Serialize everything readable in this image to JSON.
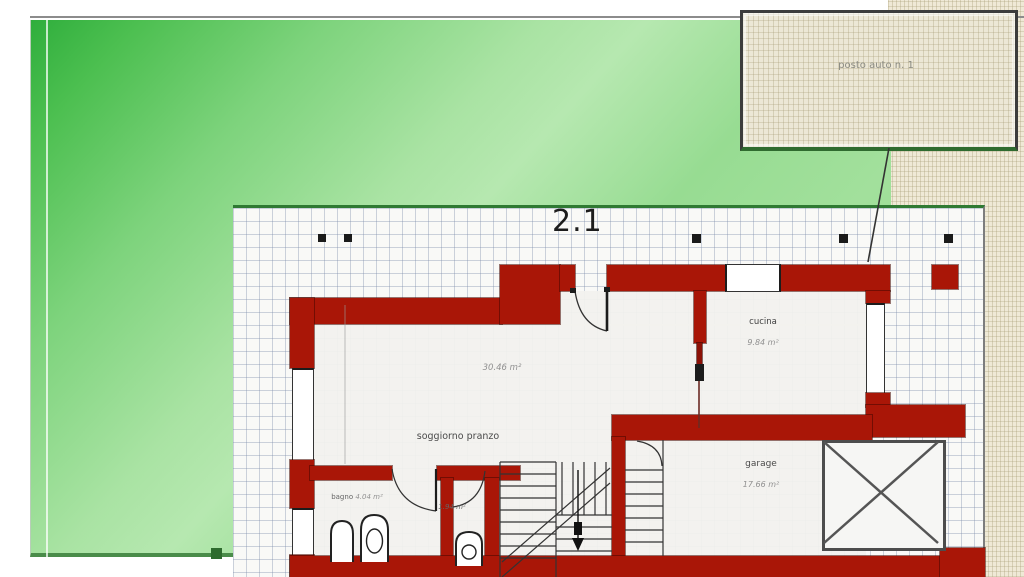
{
  "plan": {
    "floor_label": "2.1",
    "parking_label": "posto auto n. 1",
    "rooms": {
      "living": {
        "name": "soggiorno pranzo",
        "area": "30.46 m²"
      },
      "kitchen": {
        "name": "cucina",
        "area": "9.84 m²"
      },
      "garage": {
        "name": "garage",
        "area": "17.66 m²"
      },
      "bath": {
        "name": "bagno",
        "area": "4.04 m²"
      },
      "storage": {
        "area": "1.94 m²"
      }
    },
    "colors": {
      "wall_red": "#a91607",
      "lawn_green": "#8ed98a",
      "terrace_grid": "#7d8caa",
      "gravel_beige": "#efe9d6",
      "border_green": "#2f7a33"
    }
  }
}
